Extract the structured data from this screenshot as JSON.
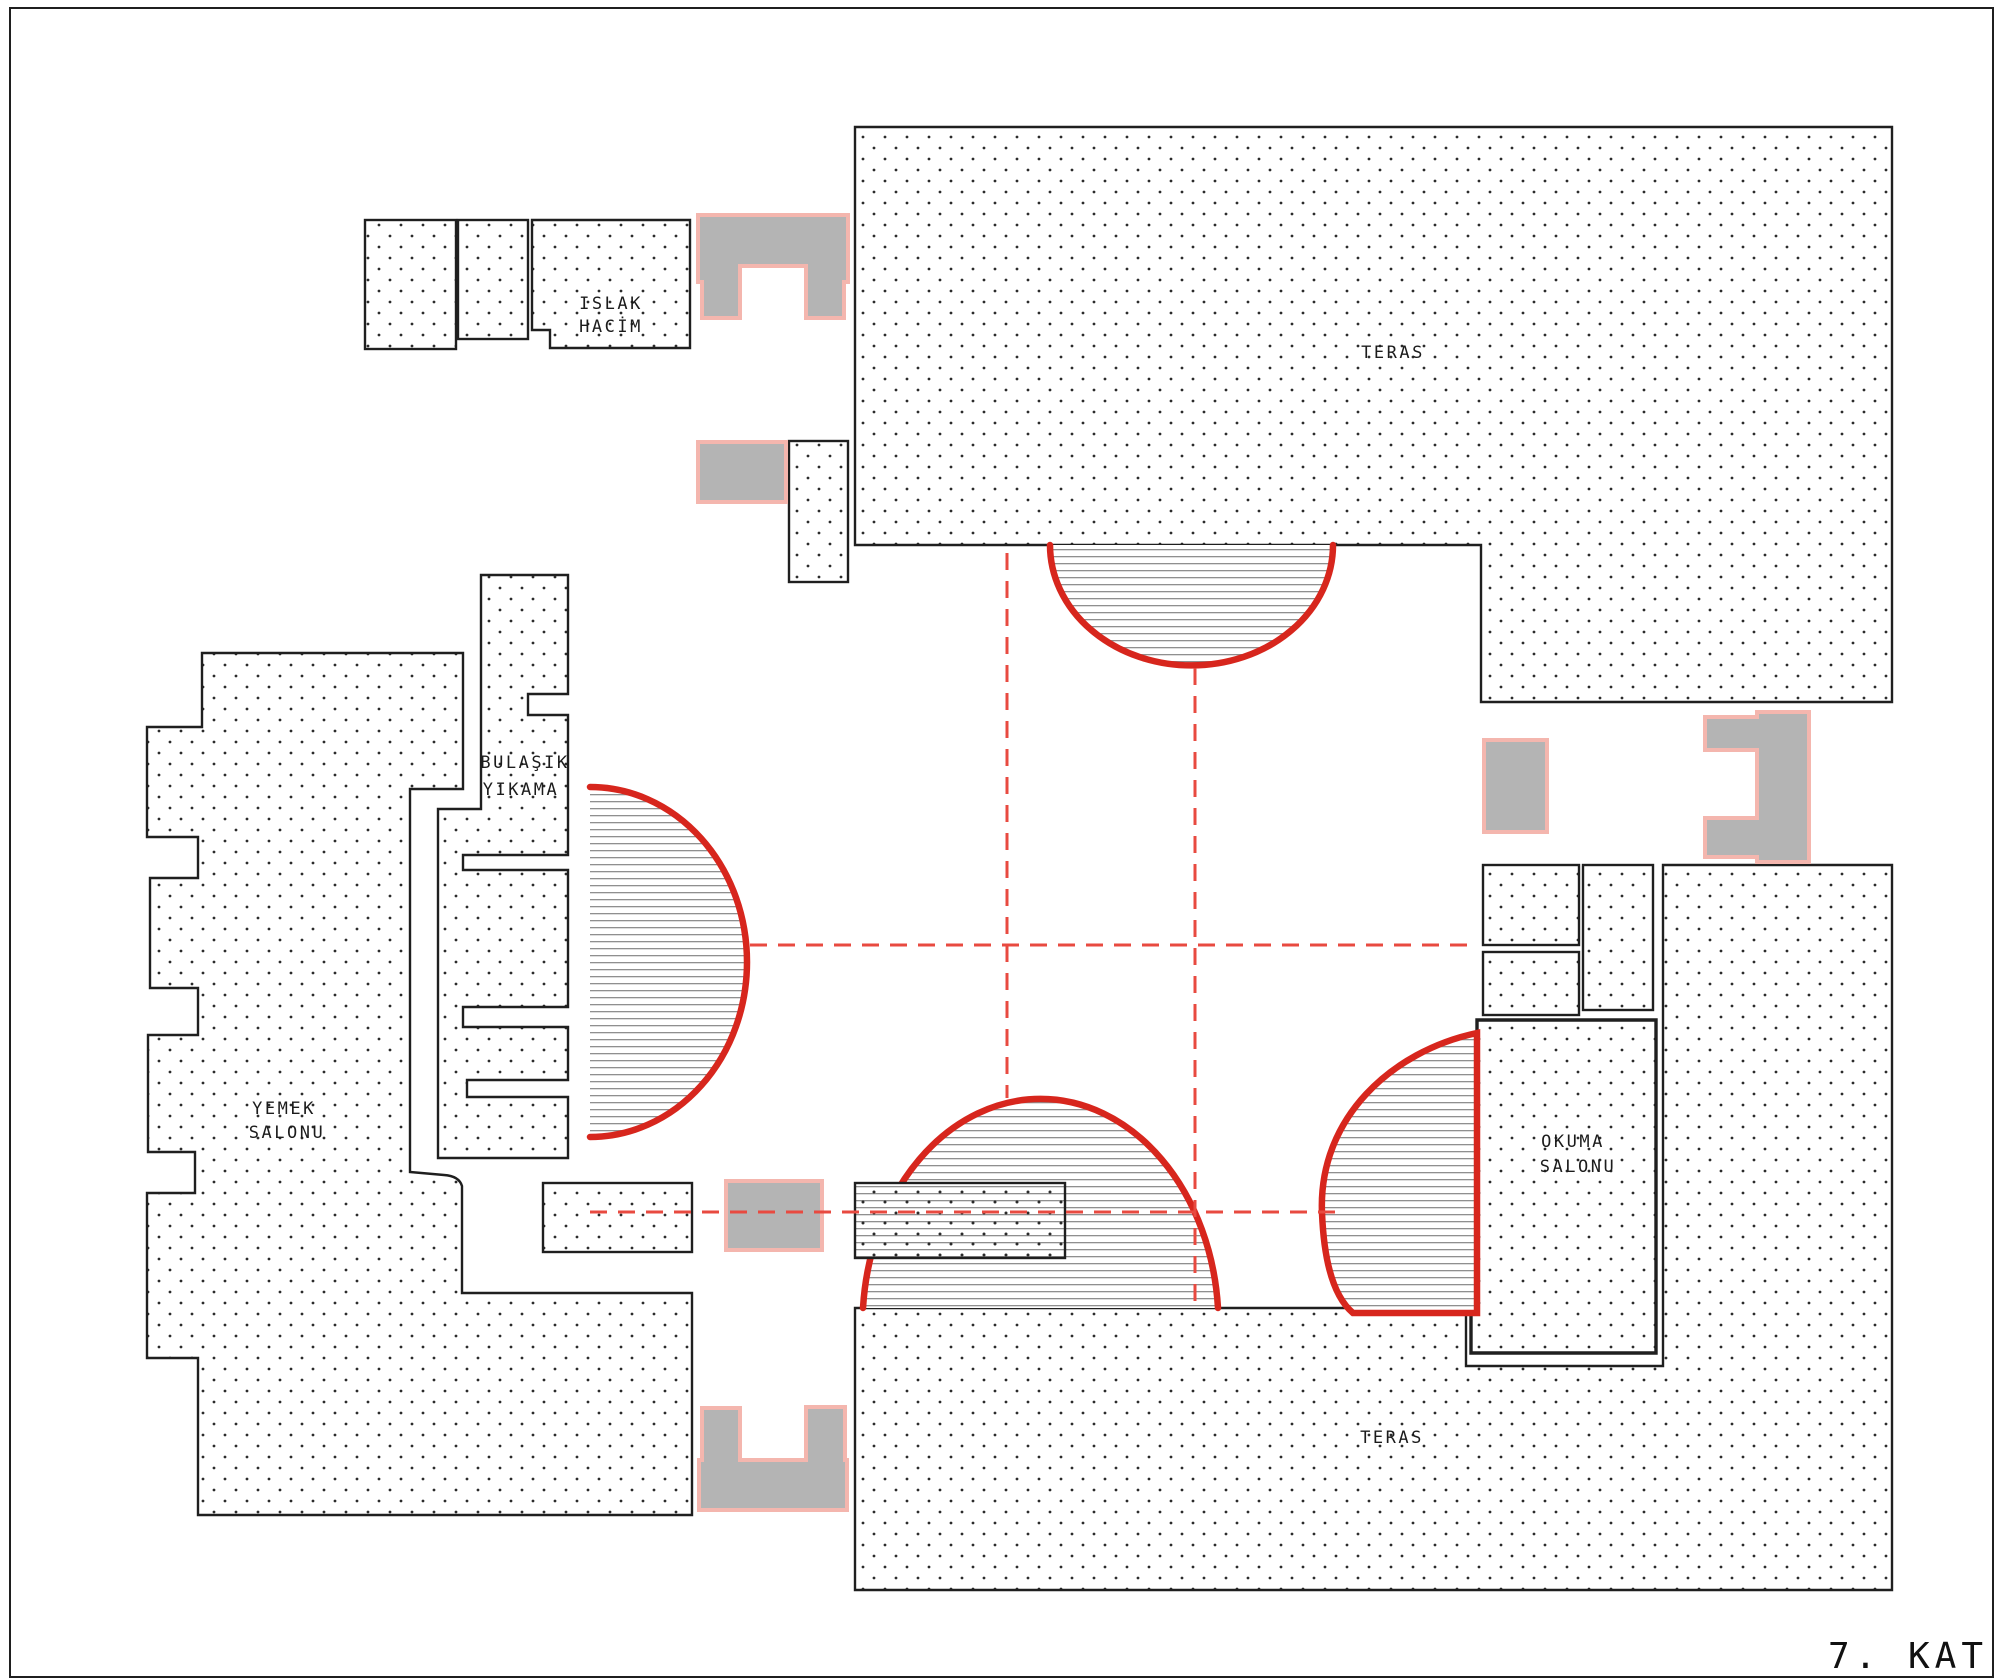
{
  "drawing": {
    "type": "architectural-floor-plan",
    "floor_title": "7. KAT",
    "rooms": [
      {
        "id": "islak-hacim",
        "label_line1": "ISLAK",
        "label_line2": "HACİM"
      },
      {
        "id": "teras-top",
        "label": "TERAS"
      },
      {
        "id": "bulasik-yikama",
        "label_line1": "BULAŞIK",
        "label_line2": "YIKAMA"
      },
      {
        "id": "yemek-salonu",
        "label_line1": "YEMEK",
        "label_line2": "SALONU"
      },
      {
        "id": "okuma-salonu",
        "label_line1": "OKUMA",
        "label_line2": "SALONU"
      },
      {
        "id": "teras-bottom",
        "label": "TERAS"
      }
    ],
    "colors": {
      "wall_line": "#1f1f1f",
      "dome_arc_red": "#d7261d",
      "axis_dashed_red": "#e84a40",
      "stair_fill_gray": "#b4b4b4",
      "stair_outline_pink": "#f4b6ae",
      "hatch_gray": "#8f8f8f",
      "paper": "#ffffff"
    }
  }
}
